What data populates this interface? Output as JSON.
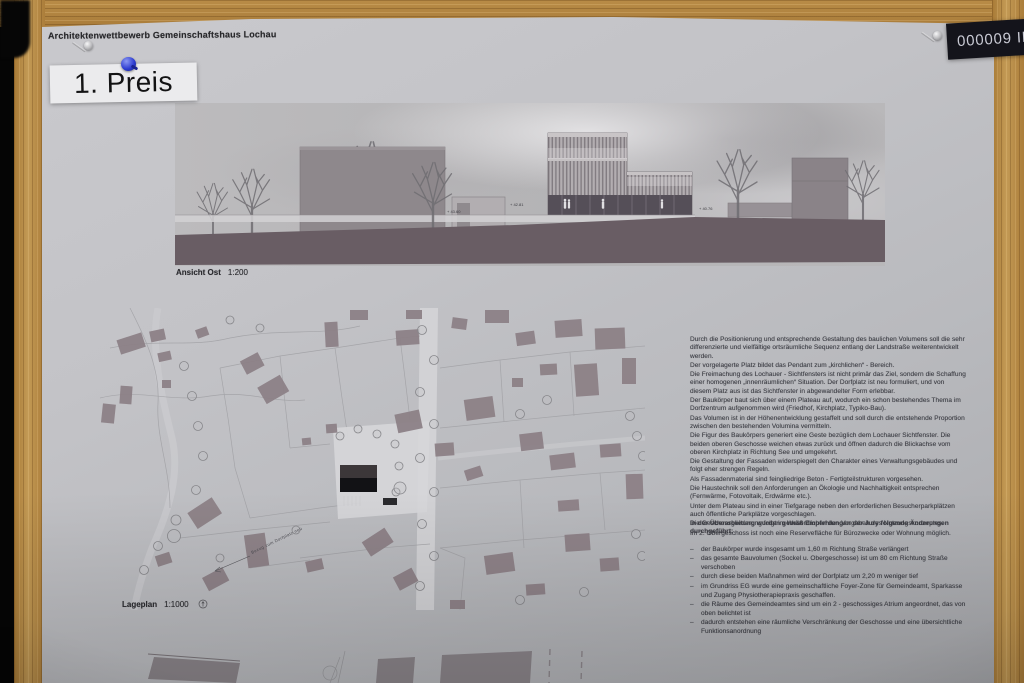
{
  "board": {
    "prize_label": "1. Preis",
    "entry_number": "000009 II"
  },
  "poster": {
    "header": "Architektenwettbewerb Gemeinschaftshaus Lochau",
    "elevation": {
      "caption": "Ansicht Ost",
      "scale": "1:200",
      "level_marks": [
        "+ 43.60",
        "+ 42.81",
        "+ 40.76"
      ]
    },
    "siteplan": {
      "caption": "Lageplan",
      "scale": "1:1000",
      "annotation": "Bezug zum Dorfplatz neu"
    },
    "jury_text": {
      "paragraphs": [
        "Durch die Positionierung und entsprechende Gestaltung des baulichen Volumens soll die sehr differenzierte und vielfältige ortsräumliche Sequenz entlang der Landstraße weiterentwickelt werden.",
        "Der vorgelagerte Platz bildet das Pendant zum „kirchlichen“ - Bereich.",
        "Die Freimachung des Lochauer - Sichtfensters ist nicht primär das Ziel, sondern die Schaffung einer homogenen „innenräumlichen“ Situation. Der Dorfplatz ist neu formuliert, und von diesem Platz aus ist das Sichtfenster in abgewandelter Form erlebbar.",
        "Der Baukörper baut sich über einem Plateau auf, wodurch ein schon bestehendes Thema im Dorfzentrum aufgenommen wird (Friedhof, Kirchplatz, Typiko-Bau).",
        "Das Volumen ist in der Höhenentwicklung gestaffelt und soll durch die entstehende Proportion zwischen den bestehenden Volumina vermitteln.",
        "Die Figur des Baukörpers generiert eine Geste bezüglich dem Lochauer Sichtfenster. Die beiden oberen Geschosse weichen etwas zurück und öffnen dadurch die Blickachse vom oberen Kirchplatz in Richtung See und umgekehrt.",
        "Die Gestaltung der Fassaden widerspiegelt den Charakter eines Verwaltungsgebäudes und folgt eher strengen Regeln.",
        "Als Fassadenmaterial sind feingliedrige Beton - Fertigteilstrukturen vorgesehen.",
        "Die Haustechnik soll den Anforderungen an Ökologie und Nachhaltigkeit entsprechen (Fernwärme, Fotovoltaik, Erdwärme etc.).",
        "Unter dem Plateau sind in einer Tiefgarage neben den erforderlichen Besucherparkplätzen auch öffentliche Parkplätze vorgeschlagen.",
        "Die Geschossgliederung folgt im Wesentlichen den Vorgaben des Nutzungskonzeptes.",
        "Im 2. Obergeschoss ist noch eine Reservefläche für Bürozwecke oder Wohnung möglich."
      ]
    },
    "revision": {
      "heading": "In der Überarbeitung wurden gemäß Empfehlungen der Jury folgende Änderungen durchgeführt:",
      "bullets": [
        "der Baukörper wurde insgesamt um 1,60 m Richtung Straße verlängert",
        "das gesamte Bauvolumen (Sockel u. Obergeschosse) ist um 80 cm Richtung Straße verschoben",
        "durch diese beiden Maßnahmen wird der Dorfplatz um 2,20 m weniger tief",
        "im Grundriss EG wurde eine gemeinschaftliche Foyer-Zone für Gemeindeamt, Sparkasse und Zugang Physiotherapiepraxis geschaffen.",
        "die Räume des Gemeindeamtes sind um ein 2 - geschossiges Atrium angeordnet, das von oben belichtet ist",
        "dadurch entstehen eine räumliche Verschränkung der Geschosse und eine übersichtliche Funktionsanordnung"
      ]
    }
  },
  "colors": {
    "wood": "#b3813d",
    "paper": "#c2c2c6",
    "ground_band": "#695d64",
    "building_gray": "#8d8288",
    "plan_dark_building": "#1b1b1e",
    "pin_blue": "#2c3bd0",
    "entry_label_bg": "#14141b"
  }
}
